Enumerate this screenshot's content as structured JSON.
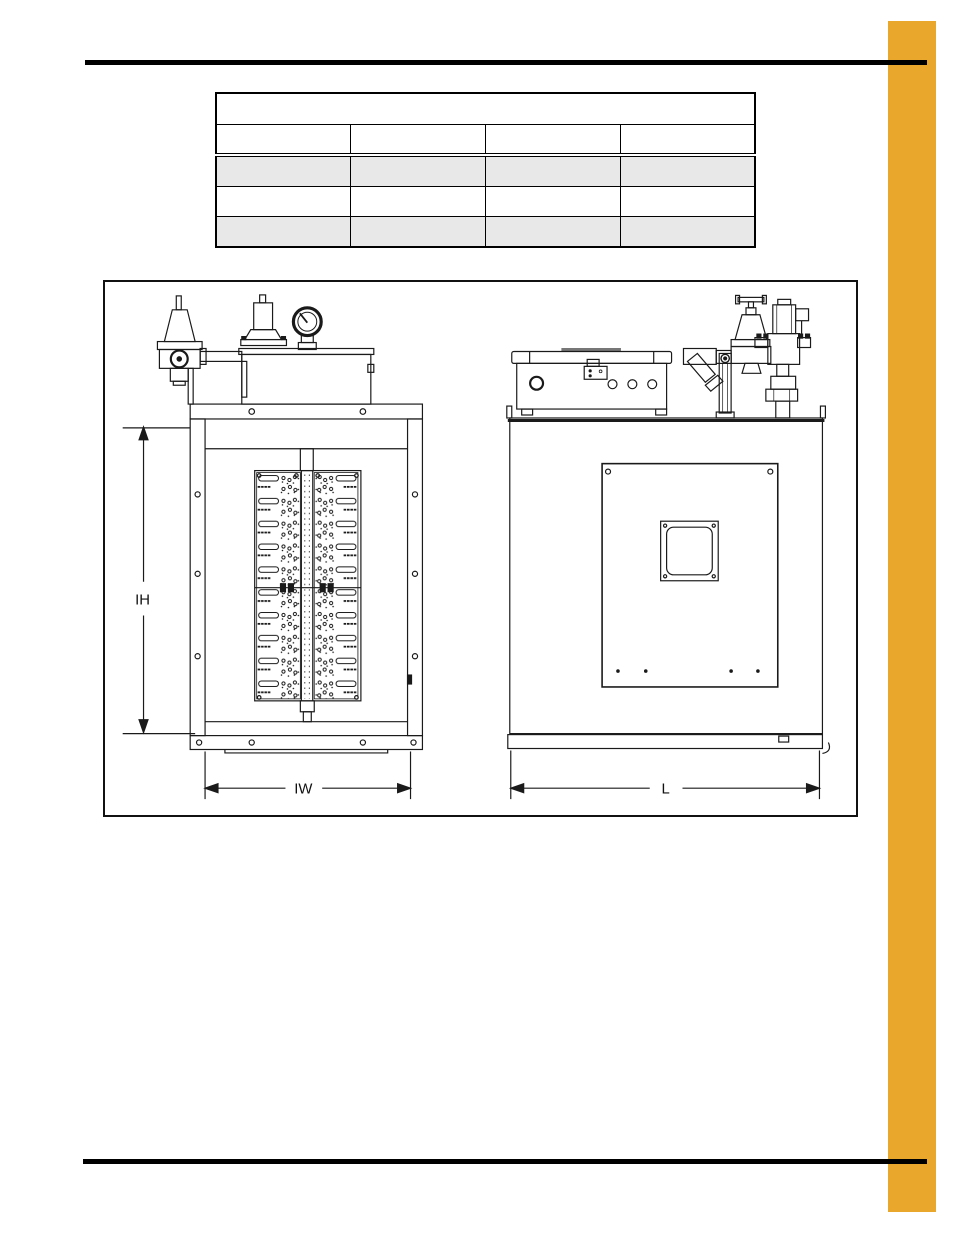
{
  "page": {
    "accent_color": "#E9A82C",
    "rule_color": "#000000",
    "row_shade_color": "#E8E8E8"
  },
  "spec_table": {
    "title_cell": "",
    "columns": [
      "",
      "",
      "",
      ""
    ],
    "rows": [
      [
        "",
        "",
        "",
        ""
      ],
      [
        "",
        "",
        "",
        ""
      ],
      [
        "",
        "",
        "",
        ""
      ]
    ]
  },
  "figure": {
    "front_view": {
      "inner_height_label": "IH",
      "inner_width_label": "IW"
    },
    "side_view": {
      "length_label": "L"
    }
  }
}
